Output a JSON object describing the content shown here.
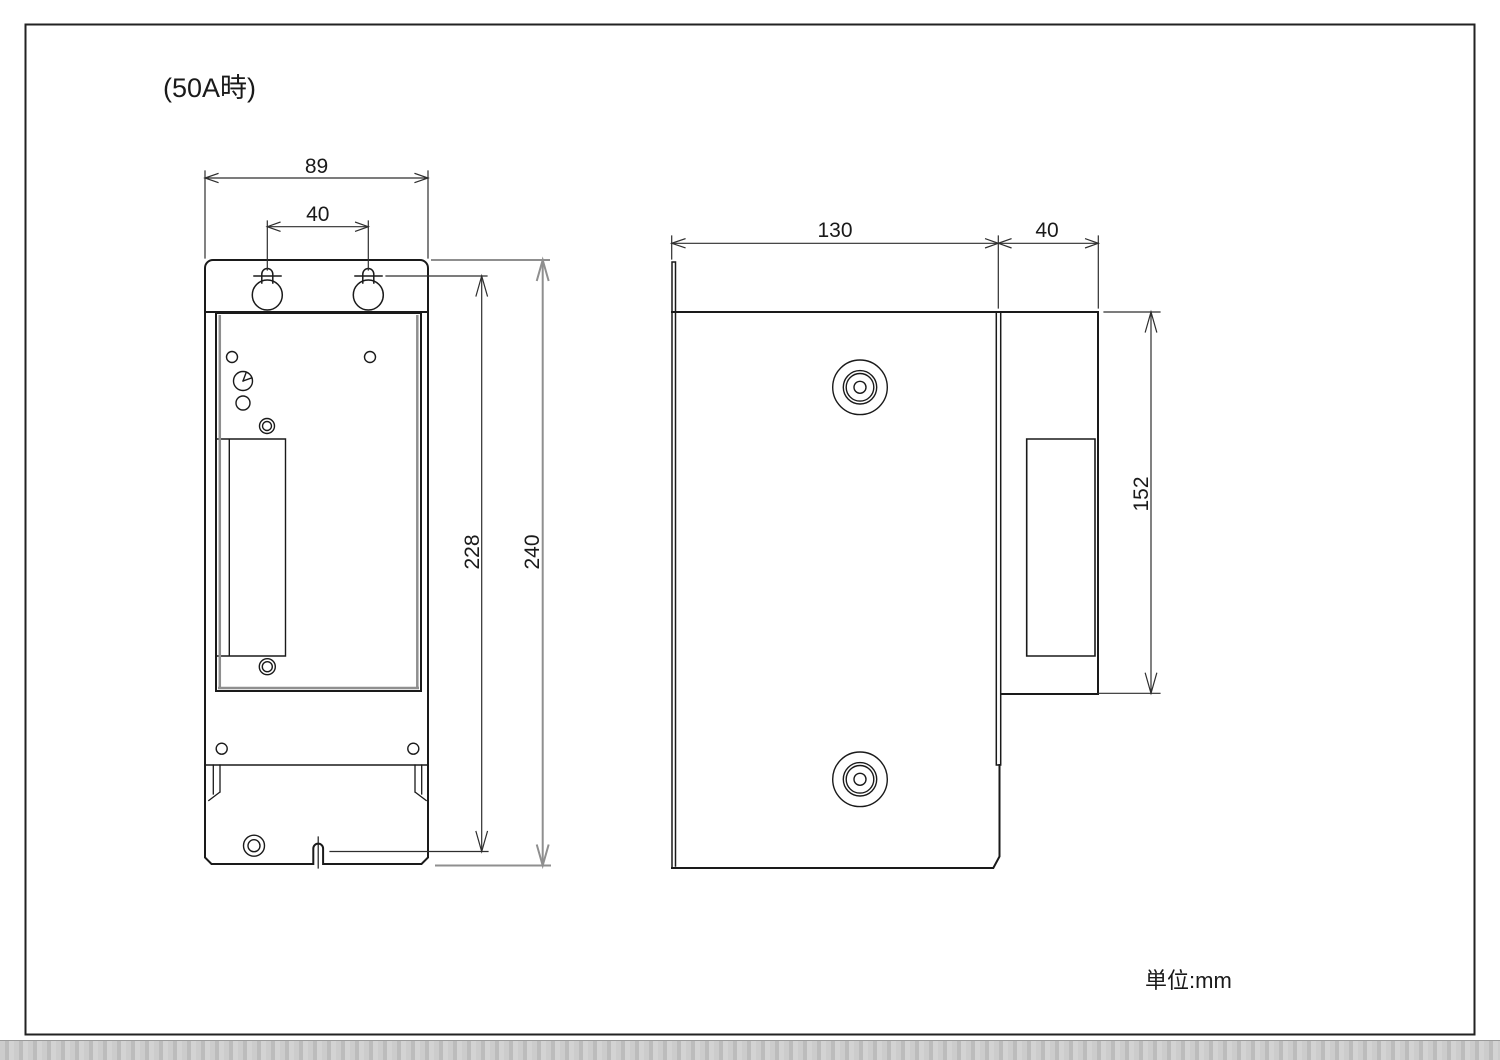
{
  "page": {
    "title": "(50A時)",
    "unit_note": "単位:mm"
  },
  "colors": {
    "line": "#1a1a1a",
    "dimension": "#2e2e2e",
    "accent_gray": "#8f8f8f",
    "background": "#ffffff"
  },
  "front_view": {
    "name": "front view (50A meter box)",
    "dimensions": {
      "overall_width": "89",
      "keyhole_pitch": "40",
      "keyhole_to_notch": "228",
      "overall_height": "240"
    }
  },
  "side_view": {
    "name": "side view",
    "dimensions": {
      "body_depth": "130",
      "cover_depth": "40",
      "cover_height": "152"
    }
  }
}
